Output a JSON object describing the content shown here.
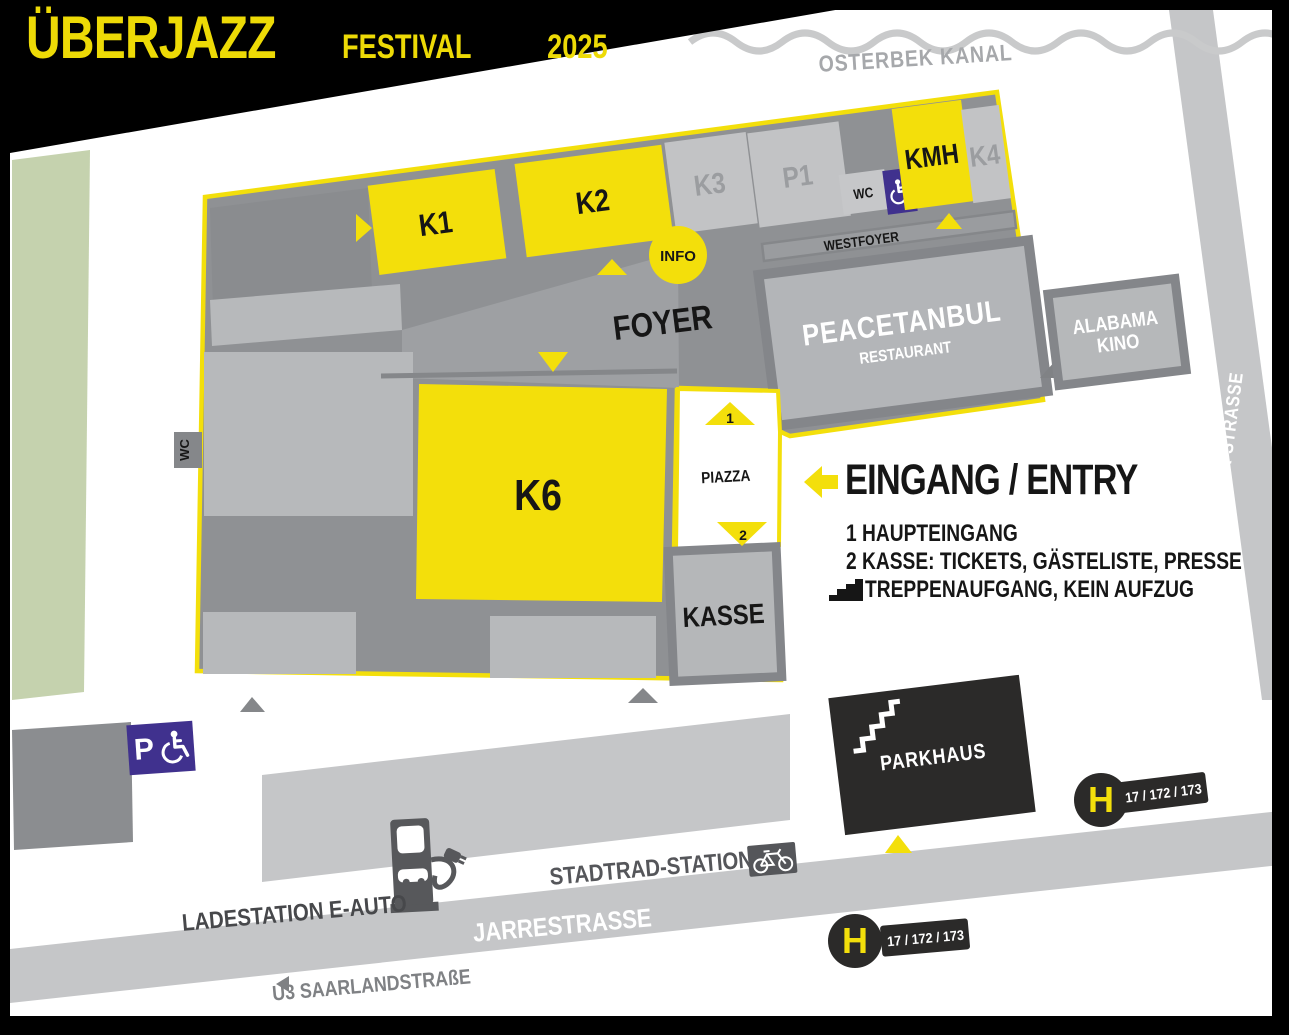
{
  "colors": {
    "yellow": "#F3DF0B",
    "purple": "#40318E",
    "building_base": "#8F9194",
    "room_light": "#C2C3C5",
    "patch_light": "#B7B9BB",
    "dark": "#2B2A29",
    "road_gray": "#C5C6C8",
    "green_area": "#C5D2AE",
    "border_gray": "#85878A"
  },
  "logo": {
    "title": "ÜBERJAZZ",
    "subtitle": "FESTIVAL",
    "year": "2025"
  },
  "canal": {
    "label": "OSTERBEK KANAL"
  },
  "streets": {
    "barmbeker": "BARMBEKER STRASSE",
    "jarrestrasse": "JARRESTRASSE",
    "u3": "U3 SAARLANDSTRAßE",
    "stadtrad": "STADTRAD-STATION",
    "ladestation": "LADESTATION E-AUTO"
  },
  "venues": {
    "k1": "K1",
    "k2": "K2",
    "k3": "K3",
    "p1": "P1",
    "k4": "K4",
    "kmh": "KMH",
    "k6": "K6",
    "wc": "WC",
    "wc_accessible": "WC",
    "wc_exterior": "WC",
    "foyer": "FOYER",
    "westfoyer": "WESTFOYER",
    "info": "INFO",
    "kasse": "KASSE",
    "piazza": "PIAZZA",
    "parkhaus": "PARKHAUS",
    "restaurant_name": "PEACETANBUL",
    "restaurant_sub": "RESTAURANT",
    "kino_line1": "ALABAMA",
    "kino_line2": "KINO"
  },
  "entry": {
    "heading": "EINGANG / ENTRY",
    "item1": "1 HAUPTEINGANG",
    "item2": "2 KASSE: TICKETS, GÄSTELISTE, PRESSE",
    "item3": "TREPPENAUFGANG, KEIN AUFZUG"
  },
  "markers": {
    "main_entrance": "1",
    "box_office": "2"
  },
  "transit": {
    "stop_letter": "H",
    "lines": "17 / 172 / 173",
    "parking_letter": "P"
  }
}
